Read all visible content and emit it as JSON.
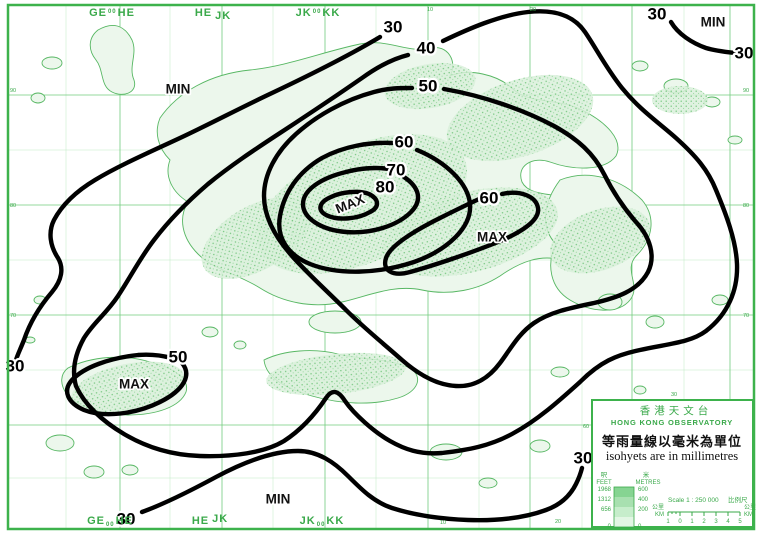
{
  "colors": {
    "border_green": "#3db24c",
    "grid_green": "#72cc7e",
    "label_green": "#3aa94a",
    "land_fill": "#ecf7ec",
    "hill_green": "#5bbb67",
    "contour_black": "#000000",
    "background": "#ffffff"
  },
  "map": {
    "isohyet_values_mm": [
      "30",
      "40",
      "50",
      "60",
      "70",
      "80"
    ],
    "contour_labels": {
      "west_30": "30",
      "diag_40": "40",
      "diag_50": "50",
      "center_60": "60",
      "center_70": "70",
      "center_80": "80",
      "east_60": "60",
      "southwest_50": "50",
      "southwest_30": "30",
      "topright_30_a": "30",
      "topright_30_b": "30",
      "bottom_30_left": "30",
      "bottom_30_right": "30"
    },
    "extremes": {
      "min_northwest": "MIN",
      "min_northeast": "MIN",
      "min_south": "MIN",
      "max_center": "MAX",
      "max_east": "MAX",
      "max_southwest": "MAX"
    },
    "zones_top": [
      {
        "a": "GE",
        "sup": "00",
        "b": "HE"
      },
      {
        "a": "HE",
        "sup": "",
        "b": "JK"
      },
      {
        "a": "JK",
        "sup": "00",
        "b": "KK"
      }
    ],
    "zones_bottom": [
      {
        "a": "GE",
        "sub": "00",
        "b": "HE"
      },
      {
        "a": "HE",
        "sub": "",
        "b": "JK"
      },
      {
        "a": "JK",
        "sub": "00",
        "b": "KK"
      }
    ],
    "edge_numbers": {
      "left": [
        "90",
        "80",
        "70"
      ],
      "right": [
        "90",
        "80",
        "70"
      ],
      "top": [
        "10",
        "20"
      ],
      "bottom": [
        "10",
        "20"
      ],
      "above_legend": "30",
      "left_of_legend": "60"
    }
  },
  "legend": {
    "org_zh": "香港天文台",
    "org_en": "HONG KONG OBSERVATORY",
    "caption_zh": "等雨量線以毫米為單位",
    "caption_en": "isohyets are in millimetres",
    "elevation": {
      "col1_zh": "呎",
      "col1_en": "FEET",
      "col2_zh": "米",
      "col2_en": "METRES",
      "feet": [
        "1968",
        "1312",
        "656",
        "0"
      ],
      "metres": [
        "600",
        "400",
        "200",
        "0"
      ]
    },
    "scale_label": "Scale 1 : 250 000",
    "scale_label_zh": "比例尺",
    "scale_ticks": [
      "1",
      "0",
      "1",
      "2",
      "3",
      "4",
      "5"
    ],
    "km_zh": "公里",
    "km_en": "KM"
  }
}
